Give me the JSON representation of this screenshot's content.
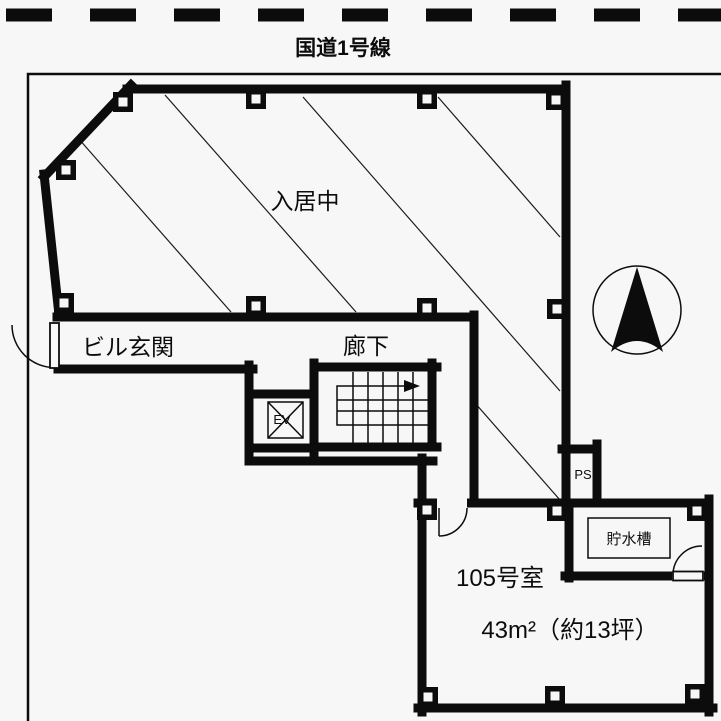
{
  "road": {
    "label": "国道1号線"
  },
  "building": {
    "occupied_area_label": "入居中",
    "entrance_label": "ビル玄関",
    "corridor_label": "廊下",
    "elevator_label": "EV",
    "pipe_space_label": "PS",
    "water_tank_label": "貯水槽"
  },
  "unit": {
    "name": "105号室",
    "area": "43m²（約13坪）"
  },
  "colors": {
    "line": "#0c0c0c",
    "background": "#f7f7f7"
  }
}
